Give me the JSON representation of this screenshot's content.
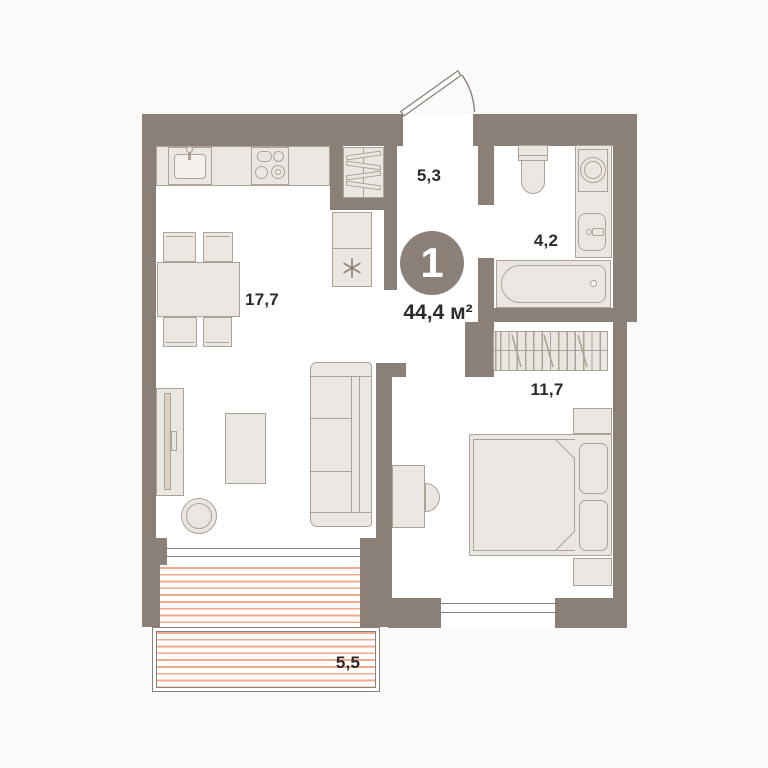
{
  "floor_plan": {
    "unit_badge": {
      "rooms_count": "1",
      "total_area": "44,4 м²"
    },
    "room_labels": {
      "living_kitchen": "17,7",
      "hallway": "5,3",
      "bathroom": "4,2",
      "bedroom": "11,7",
      "balcony": "5,5"
    },
    "colors": {
      "wall": "#8a8077",
      "room_fill": "#ffffff",
      "furniture_fill": "#eae6e1",
      "furniture_border": "#ada295",
      "balcony_hatch": "#f2a98e",
      "badge_background": "#8a8077",
      "badge_text": "#ffffff",
      "label_text": "#2d2a27"
    }
  }
}
